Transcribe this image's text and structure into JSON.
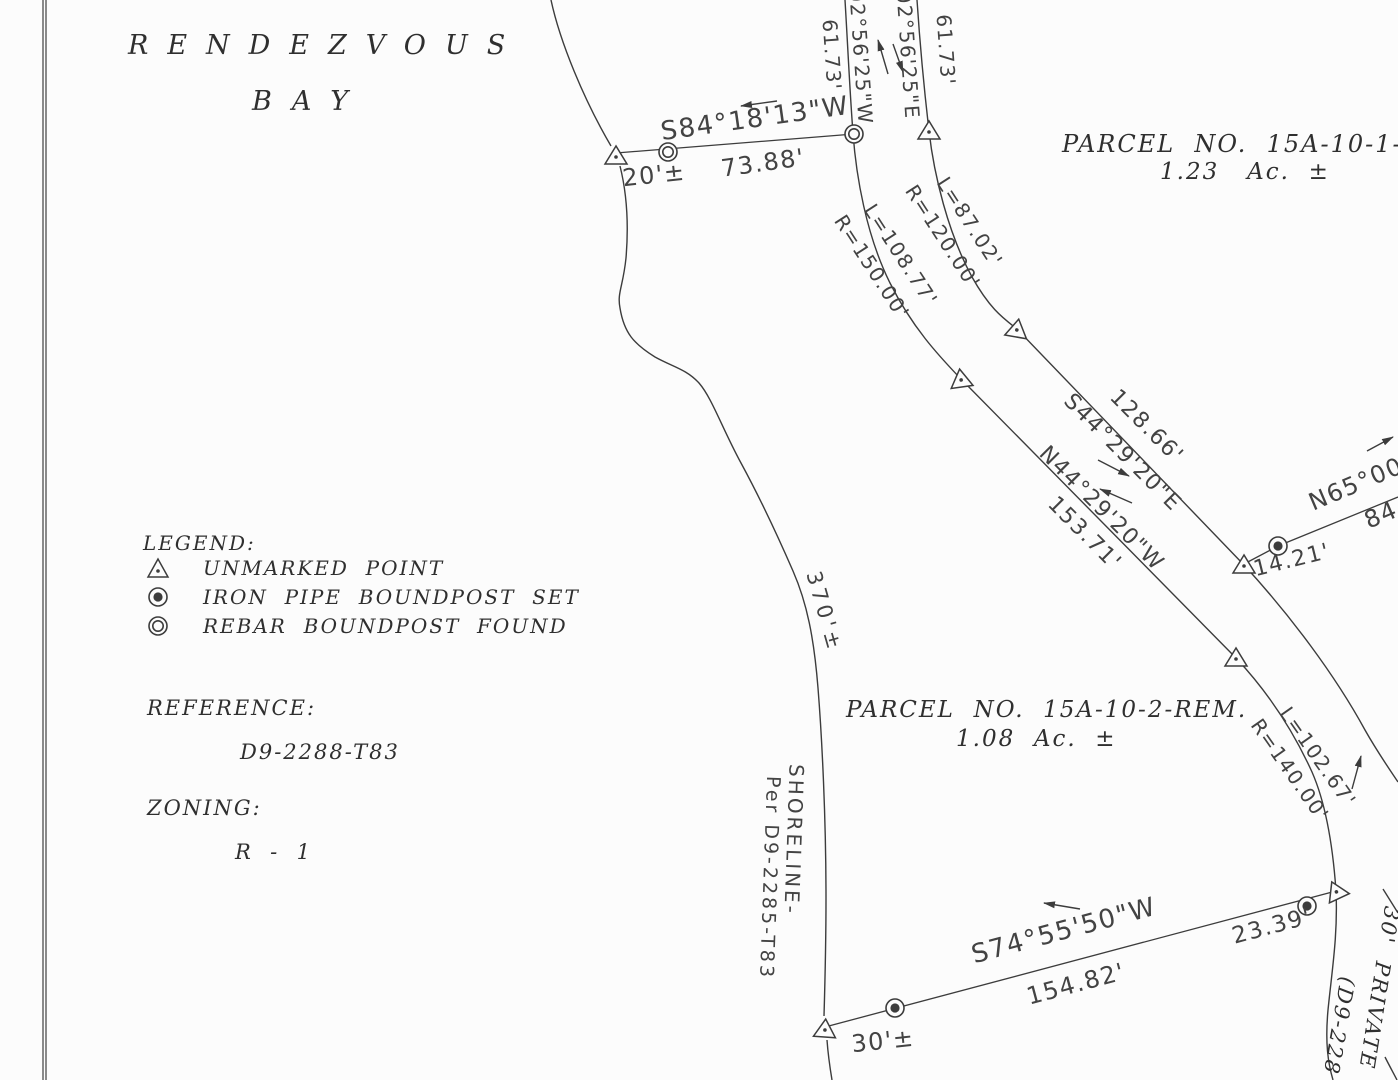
{
  "bay": {
    "line1": "RENDEZVOUS",
    "line2": "BAY"
  },
  "parcel1": {
    "name": "PARCEL  NO.  15A-10-1-RE",
    "area": "1.23   Ac.  ±"
  },
  "parcel2": {
    "name": "PARCEL  NO.  15A-10-2-REM.",
    "area": "1.08  Ac.  ±"
  },
  "legend": {
    "heading": "LEGEND:",
    "unmarked": "UNMARKED  POINT",
    "iron_pipe": "IRON  PIPE  BOUNDPOST  SET",
    "rebar": "REBAR  BOUNDPOST  FOUND"
  },
  "reference": {
    "heading": "REFERENCE:",
    "value": "D9-2288-T83"
  },
  "zoning": {
    "heading": "ZONING:",
    "value": "R  -  1"
  },
  "m": {
    "s84": "S84°18'13\"W",
    "d7388": "73.88'",
    "t20": "20'±",
    "len61w": "61.73'",
    "b02w": "02°56'25\"W",
    "b02e": "02°56'25\"E",
    "len61e": "61.73'",
    "r150": "R=150.00'",
    "l108": "L=108.77'",
    "r120": "R=120.00'",
    "l87": "L=87.02'",
    "d128": "128.66'",
    "s44": "S44°29'20\"E",
    "n44": "N44°29'20\"W",
    "d153": "153.71'",
    "n65": "N65°00",
    "d84": "84",
    "d1421": "14.21'",
    "l102": "L=102.67'",
    "r140": "R=140.00'",
    "d2339": "23.39'",
    "s74": "S74°55'50\"W",
    "d15482": "154.82'",
    "t30": "30'±",
    "shore370": "370'±",
    "shoreline": "SHORELINE-",
    "shoreref": "Per D9-2285-T83",
    "roadlbl": "30'  PRIVATE",
    "roadref": "(D9-228"
  }
}
